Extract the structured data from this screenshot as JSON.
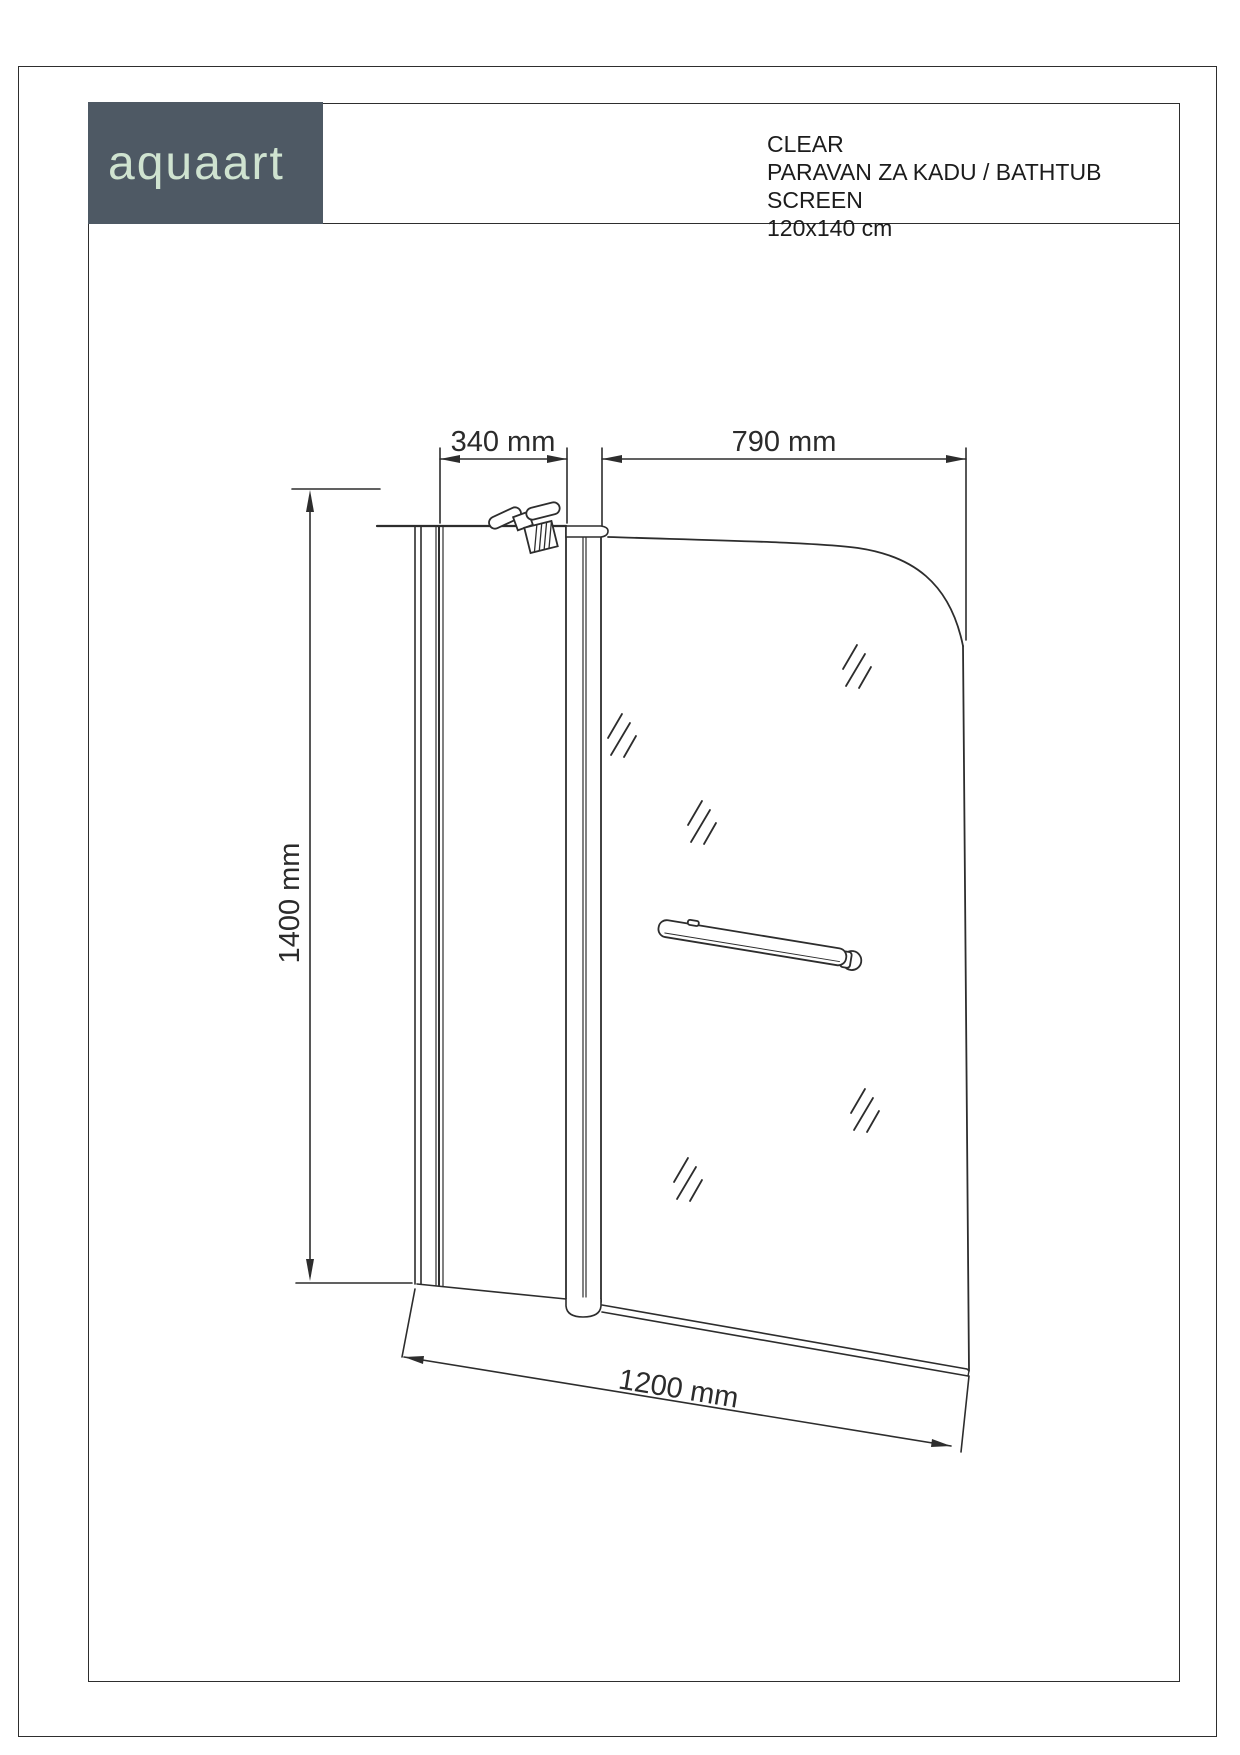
{
  "page": {
    "background": "#ffffff",
    "outer_border_color": "#2e2e2e",
    "frame_color": "#2e2e2e",
    "line_color": "#2d2d2d"
  },
  "logo": {
    "text": "aquaart",
    "background": "#4e5964",
    "text_color": "#cfe3d0"
  },
  "header": {
    "product_name": "CLEAR",
    "subtitle": "PARAVAN ZA KADU / BATHTUB SCREEN",
    "size": "120x140 cm"
  },
  "drawing": {
    "dim_fixed_panel_width": "340 mm",
    "dim_door_width": "790 mm",
    "dim_height": "1400 mm",
    "dim_total_width": "1200 mm"
  }
}
